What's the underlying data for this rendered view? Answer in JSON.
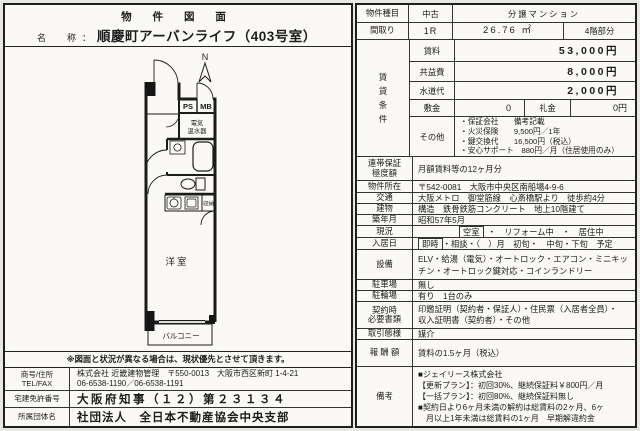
{
  "left": {
    "title": "物 件 図 面",
    "name_label": "名　称：",
    "name_value": "順慶町アーバンライフ（403号室）",
    "plan": {
      "compass": "N",
      "ps": "PS",
      "mb": "MB",
      "heater1": "電気",
      "heater2": "温水器",
      "storage": "収納",
      "room": "洋室",
      "balcony": "バルコニー"
    },
    "note": "※図面と状況が異なる場合は、現状優先とさせて頂きます。",
    "company": {
      "r1_label": "商号/住所\nTEL/FAX",
      "r1_value1": "株式会社 近畿建物管理　〒550-0013　大阪市西区新町 1-4-21",
      "r1_value2": "06-6538-1190／06-6538-1191",
      "r2_label": "宅建免許番号",
      "r2_value": "大阪府知事（１２）第２３１３４",
      "r3_label": "所属団体名",
      "r3_value": "社団法人　全日本不動産協会中央支部"
    }
  },
  "table": {
    "type": {
      "label": "物件種目",
      "v1": "中古",
      "v2": "分譲マンション"
    },
    "layout": {
      "label": "間取り",
      "v1": "1R",
      "area": "26.76 ㎡",
      "floor": "4階部分"
    },
    "rent_group": {
      "label": "賃\n貸\n条\n件",
      "rent_label": "賃料",
      "rent": "53,000円",
      "fee_label": "共益費",
      "fee": "8,000円",
      "water_label": "水道代",
      "water": "2,000円",
      "deposit_label": "敷金",
      "deposit": "0",
      "key_label": "礼金",
      "key": "0円",
      "other_label": "その他",
      "other": "・保証会社　　備考記載\n・火災保険　　9,500円／1年\n・鍵交換代　　16,500円（税込）\n・安心サポート　880円／月（住居使用のみ）"
    },
    "rows": {
      "guarantee": {
        "label": "連帯保証\n極度額",
        "value": "月額賃料等の12ヶ月分"
      },
      "address": {
        "label": "物件所在",
        "value": "〒542-0081　大阪市中央区南船場4-9-6"
      },
      "access": {
        "label": "交通",
        "value": "大阪メトロ　御堂筋線　心斎橋駅より　徒歩約4分"
      },
      "building": {
        "label": "建物",
        "value": "構造　鉄骨鉄筋コンクリート　地上10階建て"
      },
      "built": {
        "label": "築年月",
        "value": "昭和57年5月"
      },
      "status": {
        "label": "現況",
        "boxed": "空室",
        "rest": "・　リフォーム中　・　居住中"
      },
      "movein": {
        "label": "入居日",
        "boxed": "即時",
        "rest": "・相談・（　）月　初旬・　中旬・下旬　予定"
      },
      "equipment": {
        "label": "設備",
        "value": "ELV・給湯（電気）・オートロック・エアコン・ミニキッチン・オートロック鍵対応・コインランドリー"
      },
      "parking": {
        "label": "駐車場",
        "value": "無し"
      },
      "bicycle": {
        "label": "駐輪場",
        "value": "有り　1台のみ"
      },
      "docs": {
        "label": "契約時\n必要書類",
        "value": "印鑑証明（契約者・保証人）・住民票（入居者全員）・\n収入証明書（契約者）・その他"
      },
      "deal": {
        "label": "取引態様",
        "value": "媒介"
      },
      "reward": {
        "label": "報 酬 額",
        "value": "賃料の1.5ヶ月（税込）"
      },
      "remarks": {
        "label": "備考",
        "value": "■ジェイリース株式会社\n【更新プラン】：初回30%、継続保証料￥800円／月\n【一括プラン】：初回80%、継続保証料無し\n■契約日より6ヶ月未満の解約は総賃料の2ヶ月、6ヶ\n　月以上1年未満は総賃料の1ヶ月　早期解違約金"
      }
    }
  }
}
